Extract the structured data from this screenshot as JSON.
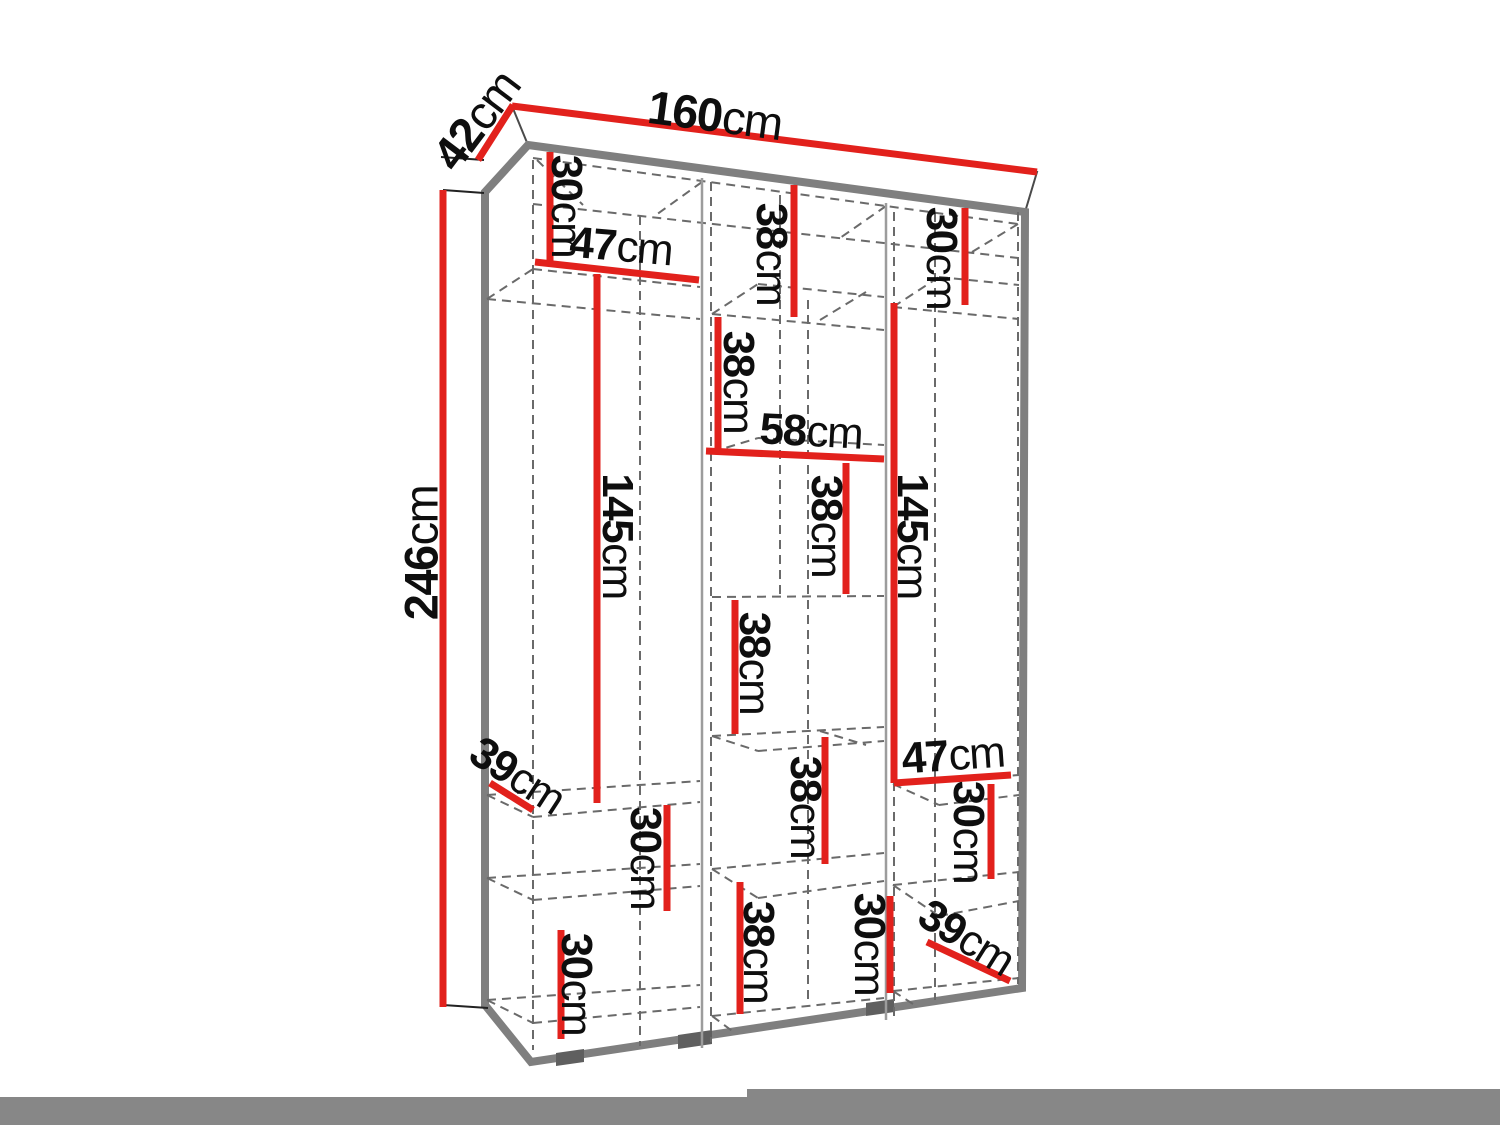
{
  "diagram": {
    "type": "furniture-dimension-drawing",
    "subject": "three-column wardrobe interior with shelves",
    "colors": {
      "dimension_line_red": "#e2211c",
      "outline_grey": "#7f7f7f",
      "dashed_grey": "#6a6a6a",
      "partition_grey": "#9c9c9c",
      "text_black": "#0e0e0e",
      "floor_shadow_grey": "#878787",
      "background": "#ffffff"
    }
  },
  "dims": {
    "overall": {
      "width": {
        "value": "160",
        "unit": "cm"
      },
      "depth": {
        "value": "42",
        "unit": "cm"
      },
      "height": {
        "value": "246",
        "unit": "cm"
      }
    },
    "interior": [
      {
        "id": "left-top-section-height",
        "value": "30",
        "unit": "cm"
      },
      {
        "id": "left-section-width",
        "value": "47",
        "unit": "cm"
      },
      {
        "id": "middle-top-section-height",
        "value": "38",
        "unit": "cm"
      },
      {
        "id": "right-top-section-height",
        "value": "30",
        "unit": "cm"
      },
      {
        "id": "middle-second-section",
        "value": "38",
        "unit": "cm"
      },
      {
        "id": "middle-section-width",
        "value": "58",
        "unit": "cm"
      },
      {
        "id": "middle-third-section",
        "value": "38",
        "unit": "cm"
      },
      {
        "id": "left-hanging-height",
        "value": "145",
        "unit": "cm"
      },
      {
        "id": "right-hanging-height",
        "value": "145",
        "unit": "cm"
      },
      {
        "id": "middle-fourth-section",
        "value": "38",
        "unit": "cm"
      },
      {
        "id": "left-shelf-depth",
        "value": "39",
        "unit": "cm"
      },
      {
        "id": "right-section-width",
        "value": "47",
        "unit": "cm"
      },
      {
        "id": "middle-fifth-section",
        "value": "38",
        "unit": "cm"
      },
      {
        "id": "right-lower-section-height",
        "value": "30",
        "unit": "cm"
      },
      {
        "id": "left-lower-section-height",
        "value": "30",
        "unit": "cm"
      },
      {
        "id": "left-bottom-section-height",
        "value": "30",
        "unit": "cm"
      },
      {
        "id": "middle-bottom-section",
        "value": "38",
        "unit": "cm"
      },
      {
        "id": "right-bottom-section-height",
        "value": "30",
        "unit": "cm"
      },
      {
        "id": "right-shelf-depth",
        "value": "39",
        "unit": "cm"
      }
    ]
  }
}
